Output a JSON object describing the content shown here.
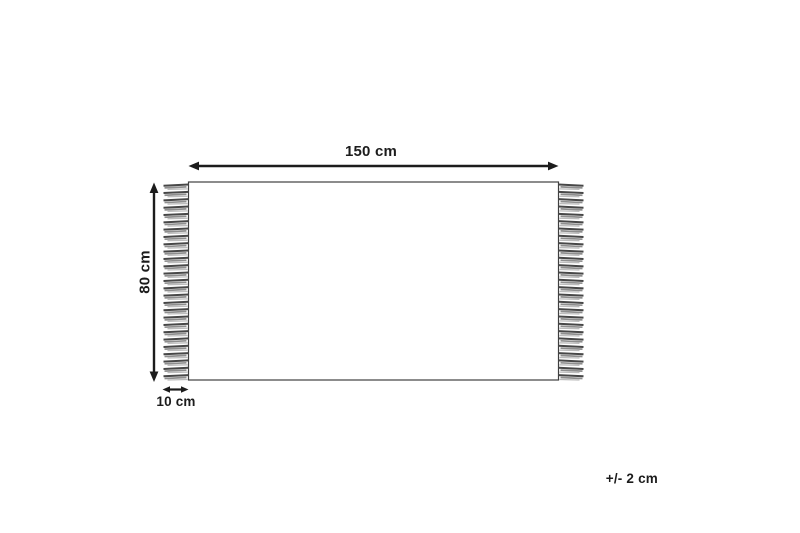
{
  "page": {
    "background_color": "#ffffff"
  },
  "diagram": {
    "kind": "rug-dimension-diagram",
    "labels": {
      "width": "150 cm",
      "height": "80 cm",
      "fringe_width": "10 cm",
      "tolerance": "+/- 2 cm"
    },
    "colors": {
      "arrow": "#1c1c1c",
      "text": "#1c1c1c",
      "rug_outline": "#3f3f3f",
      "rug_fill": "#ffffff",
      "tassel_dark": "#474747",
      "tassel_mid": "#8e8e8e",
      "tassel_light": "#bcbcbc"
    },
    "fringe": {
      "tassels_per_side": 27
    }
  }
}
